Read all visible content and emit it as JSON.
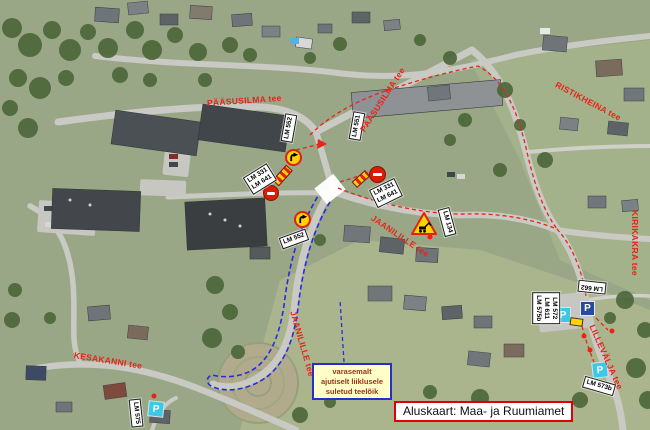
{
  "streets": [
    {
      "id": "paasusilma-west",
      "text": "PÄÄSUSILMA tee"
    },
    {
      "id": "paasusilma-north",
      "text": "PÄÄSUSILMA tee"
    },
    {
      "id": "ristikheina",
      "text": "RISTIKHEINA tee"
    },
    {
      "id": "jaanilille-east",
      "text": "JAANILILLE tee"
    },
    {
      "id": "jaanilille-south",
      "text": "JAANILILLE tee"
    },
    {
      "id": "kesakanni",
      "text": "KESAKANNI tee"
    },
    {
      "id": "lillevalja",
      "text": "LILLEVÄLJA tee"
    },
    {
      "id": "kirikakra",
      "text": "KIRIKAKRA tee"
    }
  ],
  "sign_labels": {
    "north_a": "LM 552",
    "north_b": "LM 551",
    "west_line1": "LM 331",
    "west_line2": "LM 641",
    "east_line1": "LM 331",
    "east_line2": "LM 641",
    "south_detour": "LM 552",
    "roadworks": "LM 134",
    "parking_line1": "LM 572",
    "parking_line2": "LM 611",
    "parking_line3": "LM 575b",
    "parking_extra": "LM 662",
    "southwest": "LM 575",
    "southeast": "LM 573b"
  },
  "signs": {
    "parking_glyph": "P"
  },
  "note_box": {
    "line1": "varasemalt",
    "line2": "ajutiselt liiklusele",
    "line3": "suletud teelõik"
  },
  "credit": "Aluskaart: Maa- ja Ruumiamet",
  "colors": {
    "street_label": "#e8231a",
    "closed_section_outline": "#2a2ae0",
    "detour_route": "#e8231a",
    "note_background": "#ffffc8",
    "note_border": "#2630c8",
    "note_text": "#a03020",
    "credit_border": "#e00000",
    "sign_label_background": "#ffffff",
    "sign_yellow": "#ffd400",
    "no_entry_red": "#d81e05",
    "parking_blue": "#274b9b",
    "parking_cyan": "#3cc9e8"
  }
}
